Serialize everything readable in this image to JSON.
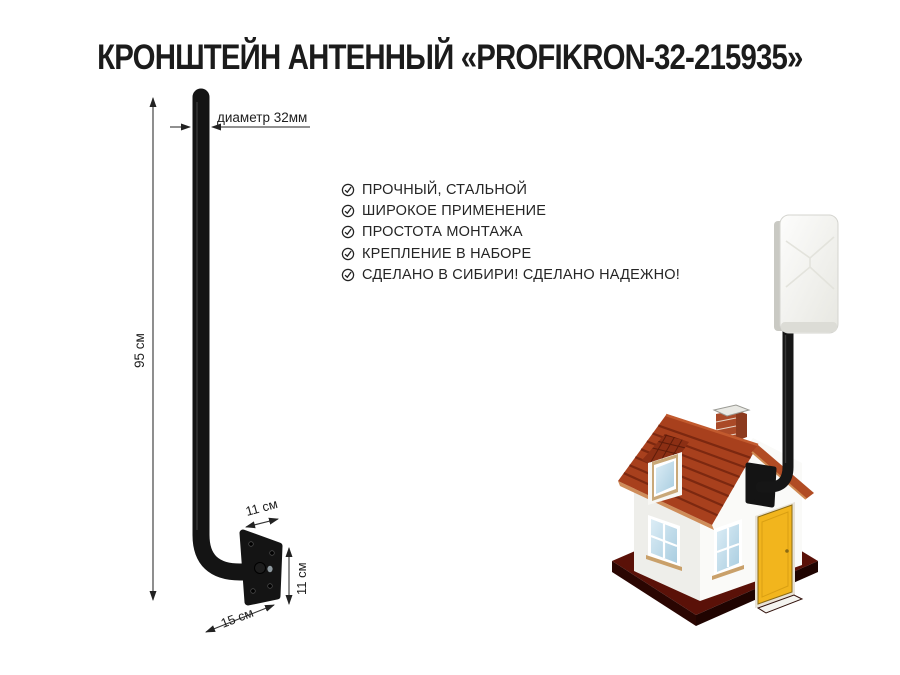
{
  "title": "КРОНШТЕЙН АНТЕННЫЙ «PROFIKRON-32-215935»",
  "features": {
    "icon": "check-circle-icon",
    "items": [
      {
        "label": "ПРОЧНЫЙ, СТАЛЬНОЙ"
      },
      {
        "label": "ШИРОКОЕ ПРИМЕНЕНИЕ"
      },
      {
        "label": "ПРОСТОТА МОНТАЖА"
      },
      {
        "label": "КРЕПЛЕНИЕ В НАБОРЕ"
      },
      {
        "label": "СДЕЛАНО В СИБИРИ! СДЕЛАНО НАДЕЖНО!"
      }
    ]
  },
  "diagram": {
    "height_label": "95 см",
    "diameter_label": "диаметр 32мм",
    "plate_top_label": "11 см",
    "plate_side_label": "11 см",
    "depth_label": "15 см"
  },
  "colors": {
    "text": "#1d1d1d",
    "metal_black": "#151515",
    "roof_red": "#a8401d",
    "roof_stripe": "#7c2810",
    "fascia_tan": "#cf8d5a",
    "base_maroon": "#5a1108",
    "door_yellow": "#f2b51d",
    "window_blue": "#b9d7e8",
    "antenna_white": "#f2f2ee"
  }
}
